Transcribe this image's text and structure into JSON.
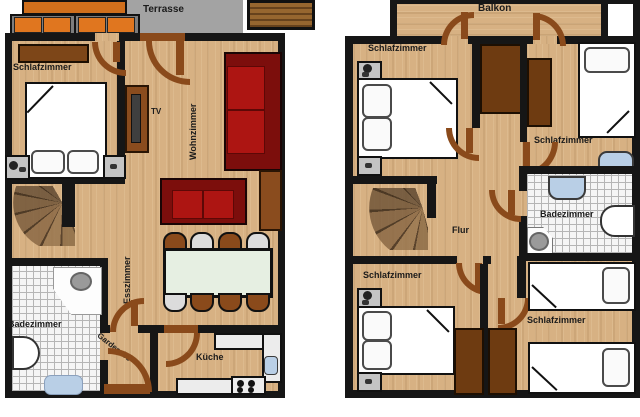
{
  "ground_floor": {
    "labels": {
      "terrasse": "Terrasse",
      "schlafzimmer": "Schlafzimmer",
      "tv": "TV",
      "wohnzimmer": "Wohnzimmer",
      "esszimmer": "Esszimmer",
      "badezimmer": "Badezimmer",
      "garderobe": "Garderobe",
      "kueche": "Küche"
    }
  },
  "upper_floor": {
    "labels": {
      "balkon": "Balkon",
      "schlafzimmer_nw": "Schlafzimmer",
      "schlafzimmer_ne": "Schlafzimmer",
      "badezimmer": "Badezimmer",
      "flur": "Flur",
      "schlafzimmer_sw": "Schlafzimmer",
      "schlafzimmer_se": "Schlafzimmer"
    }
  },
  "palette": {
    "wood_floor": "#d7b183",
    "wall": "#161616",
    "door_brown": "#8a4a1b",
    "terrace_gray": "#a3a3a3",
    "sofa_red": "#ad1512",
    "furniture_brown": "#6e3b11",
    "sink_blue": "#b9cfe6",
    "dining_table": "#e6efe2",
    "cushion_orange": "#e0761f"
  }
}
